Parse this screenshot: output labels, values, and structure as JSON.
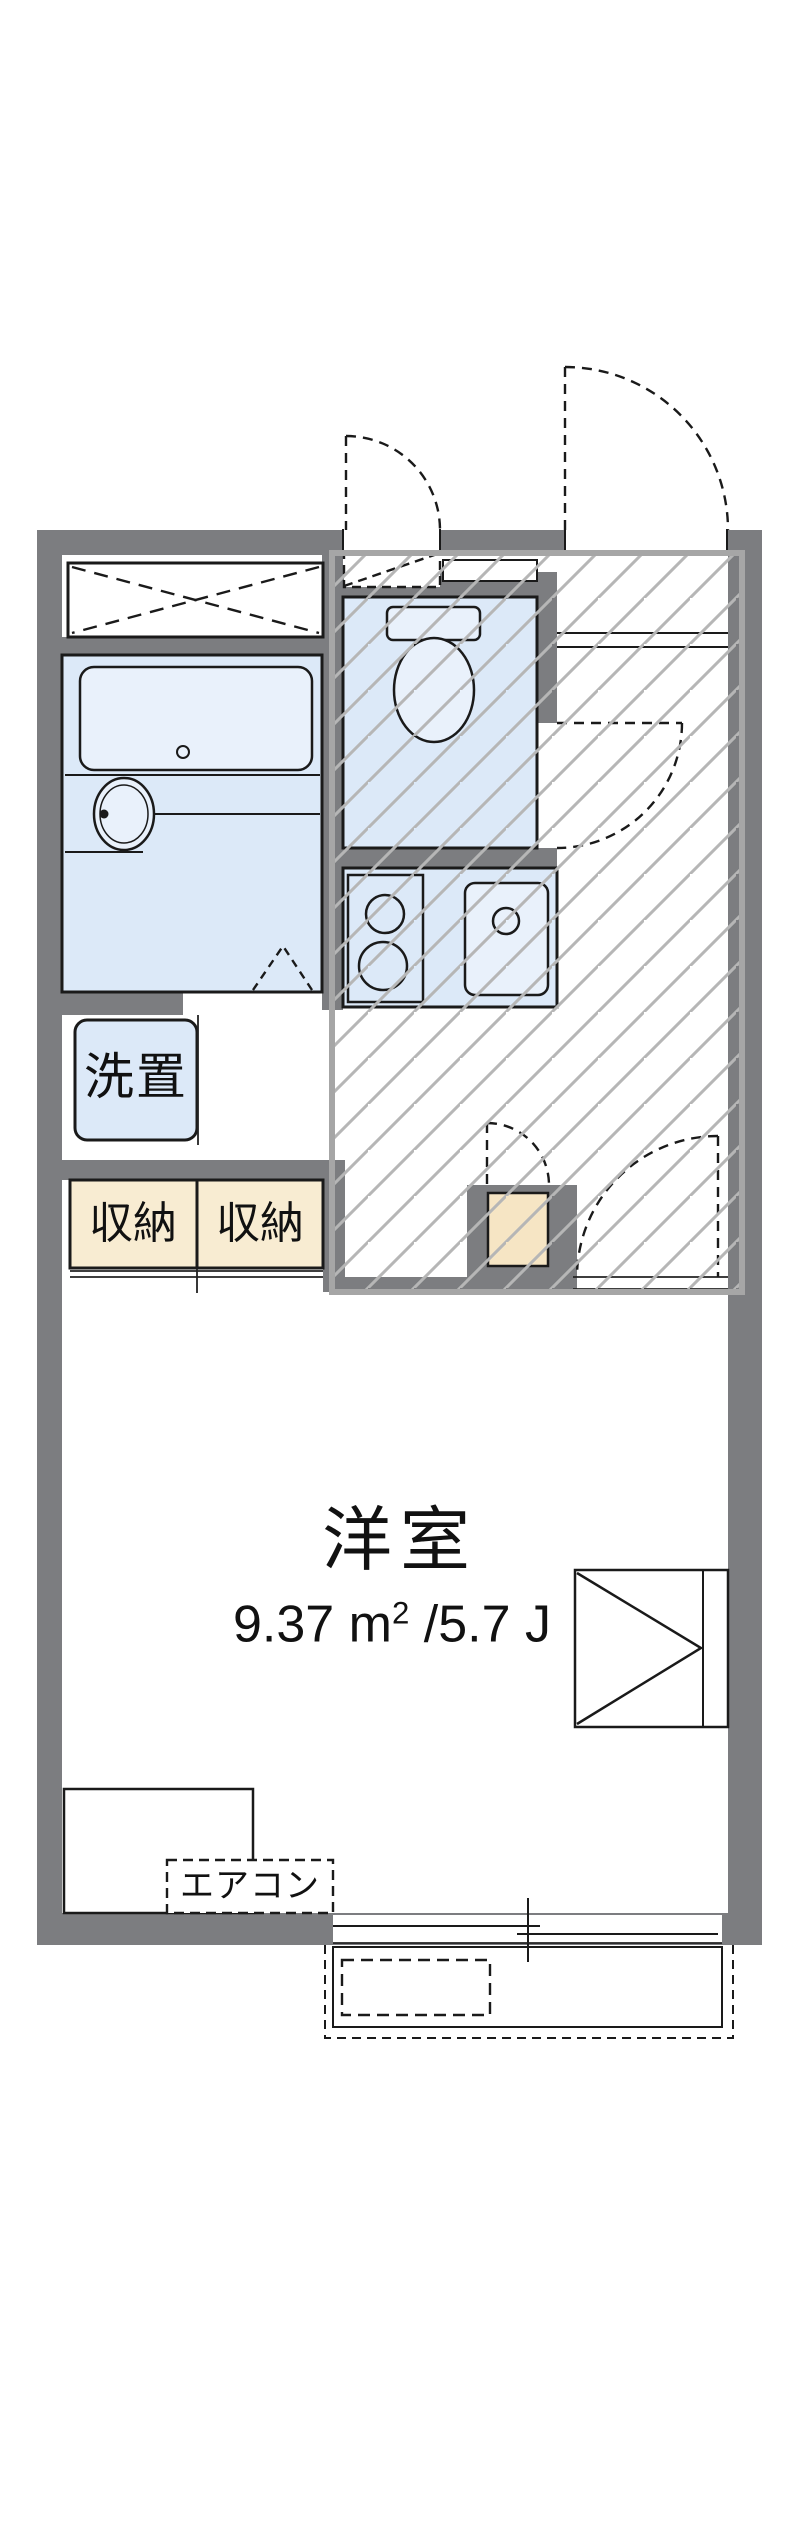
{
  "floorplan": {
    "labels": {
      "laundry": "洗置",
      "storage_left": "収納",
      "storage_right": "収納",
      "room_name": "洋室",
      "room_area": "9.37 ㎡ /5.7 J",
      "room_area_parts": {
        "before": "9.37 m",
        "sup": "2",
        "after": " /5.7 J"
      },
      "aircon": "エアコン"
    },
    "colors": {
      "wall": "#7c7d80",
      "room_fill": "#dce9f8",
      "fixture_fill": "#e9f1fb",
      "storage_fill": "#f8ecd2",
      "niche_fill": "#f6e5c4",
      "hatch_line": "#b6b6b6",
      "hatch_frame": "#a6a6a6",
      "line": "#1a1a1a"
    }
  }
}
